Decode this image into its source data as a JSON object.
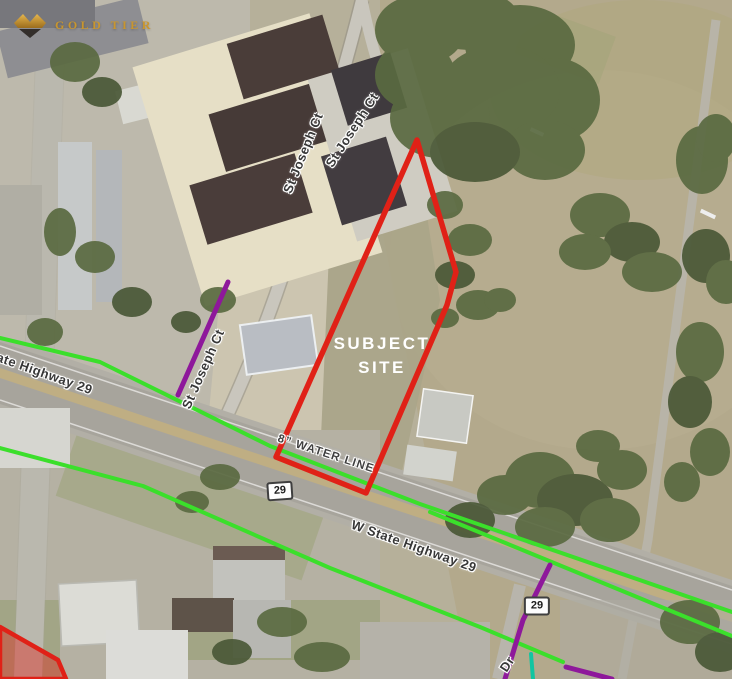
{
  "logo": {
    "brand": "GOLD TIER"
  },
  "map": {
    "site": {
      "line1": "SUBJECT",
      "line2": "SITE"
    },
    "labels": {
      "water_line": "8” WATER LINE",
      "st_joseph_a": "St Joseph Ct",
      "st_joseph_b": "St Joseph Ct",
      "st_joseph_c": "St Joseph Ct",
      "highway_left": "State Highway 29",
      "highway_center": "W State Highway 29",
      "dr_street": "Dr"
    },
    "shields": [
      {
        "number": "29"
      },
      {
        "number": "29"
      }
    ]
  },
  "colors": {
    "c-red": "#e02117",
    "c-green": "#3bdf2b",
    "c-purple": "#8e189b",
    "c-teal": "#12c5a1",
    "c-gold": "#c9962e",
    "c-label": "#383838",
    "c-tree": "#5a6a41"
  }
}
